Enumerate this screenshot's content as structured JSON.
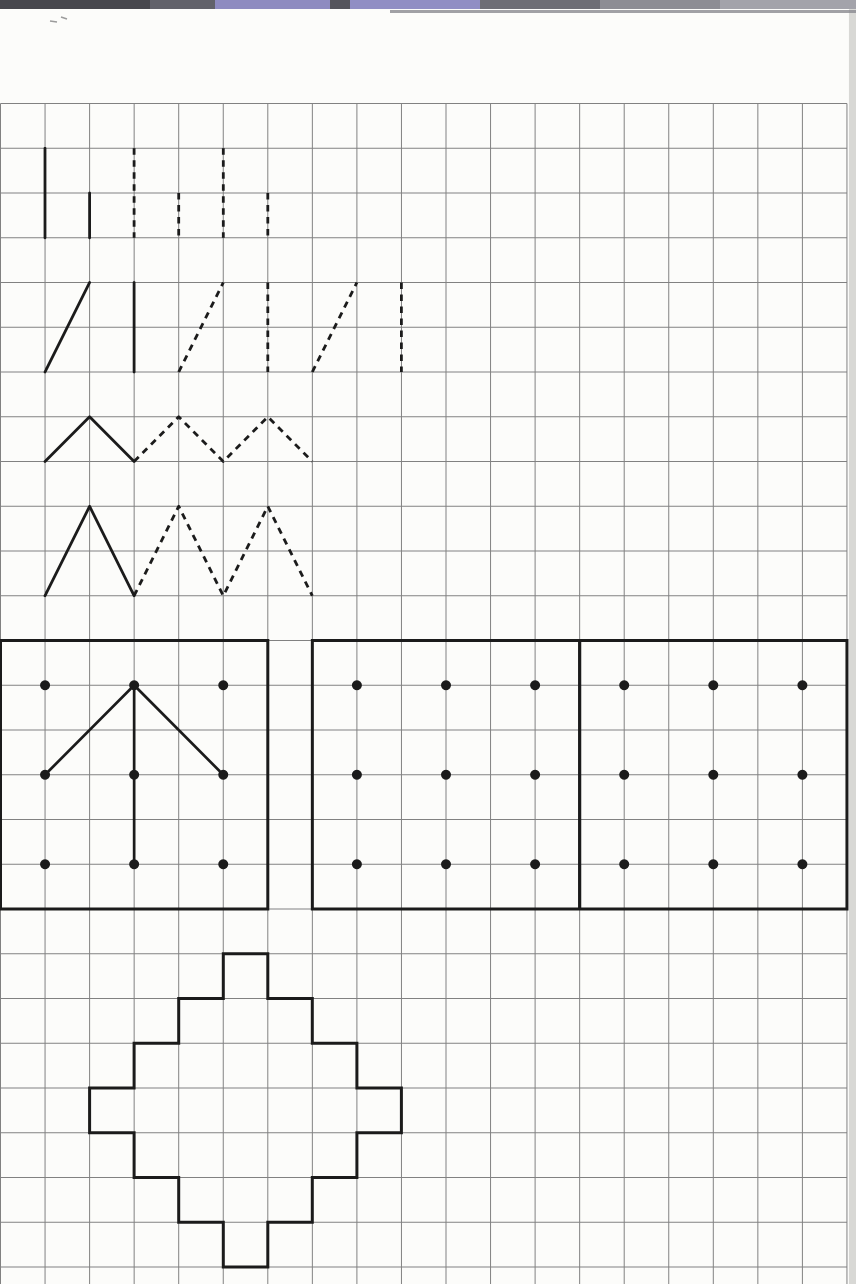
{
  "page": {
    "width": 856,
    "height": 1284,
    "background": "#fcfcfa",
    "ink_color": "#1b1b1b",
    "grid_color": "#818181",
    "paper_edge_color": "#d8d8d5",
    "pencil_color": "#9b9b9b",
    "grid": {
      "origin_x": 0.5,
      "origin_y": 103.5,
      "cell_w": 44.55,
      "cell_h": 44.75,
      "cols": 19,
      "rows": 26,
      "bottom": 1284
    },
    "scan_strip": {
      "height": 9,
      "segments": [
        {
          "x": 0,
          "w": 150,
          "color": "#47474d"
        },
        {
          "x": 150,
          "w": 65,
          "color": "#62626a"
        },
        {
          "x": 215,
          "w": 115,
          "color": "#8e8bc0"
        },
        {
          "x": 330,
          "w": 20,
          "color": "#55555c"
        },
        {
          "x": 350,
          "w": 130,
          "color": "#918ec4"
        },
        {
          "x": 480,
          "w": 120,
          "color": "#6e6e75"
        },
        {
          "x": 600,
          "w": 120,
          "color": "#8d8d94"
        },
        {
          "x": 720,
          "w": 136,
          "color": "#a3a3aa"
        }
      ],
      "underline": {
        "x": 390,
        "y": 10,
        "w": 466,
        "h": 3,
        "color": "#8a8a90"
      }
    },
    "pencil_marks": [
      {
        "x1": 50,
        "y1": 21,
        "x2": 57,
        "y2": 22
      },
      {
        "x1": 61,
        "y1": 17,
        "x2": 67,
        "y2": 19
      }
    ]
  },
  "practice_strokes": {
    "stroke_width": 2.8,
    "dash_pattern": "6.5 5.5",
    "rows": [
      {
        "name": "vertical-lines",
        "items": [
          {
            "style": "solid",
            "points": [
              [
                1,
                1
              ],
              [
                1,
                3
              ]
            ]
          },
          {
            "style": "solid",
            "points": [
              [
                2,
                2
              ],
              [
                2,
                3
              ]
            ]
          },
          {
            "style": "dashed",
            "points": [
              [
                3,
                1
              ],
              [
                3,
                3
              ]
            ]
          },
          {
            "style": "dashed",
            "points": [
              [
                4,
                2
              ],
              [
                4,
                3
              ]
            ]
          },
          {
            "style": "dashed",
            "points": [
              [
                5,
                1
              ],
              [
                5,
                3
              ]
            ]
          },
          {
            "style": "dashed",
            "points": [
              [
                6,
                2
              ],
              [
                6,
                3
              ]
            ]
          }
        ]
      },
      {
        "name": "slants-and-verticals",
        "items": [
          {
            "style": "solid",
            "points": [
              [
                1,
                6
              ],
              [
                2,
                4
              ]
            ]
          },
          {
            "style": "solid",
            "points": [
              [
                3,
                4
              ],
              [
                3,
                6
              ]
            ]
          },
          {
            "style": "dashed",
            "points": [
              [
                4,
                6
              ],
              [
                5,
                4
              ]
            ]
          },
          {
            "style": "dashed",
            "points": [
              [
                6,
                4
              ],
              [
                6,
                6
              ]
            ]
          },
          {
            "style": "dashed",
            "points": [
              [
                7,
                6
              ],
              [
                8,
                4
              ]
            ]
          },
          {
            "style": "dashed",
            "points": [
              [
                9,
                4
              ],
              [
                9,
                6
              ]
            ]
          }
        ]
      },
      {
        "name": "small-zigzag",
        "items": [
          {
            "style": "solid",
            "points": [
              [
                1,
                8
              ],
              [
                2,
                7
              ],
              [
                3,
                8
              ]
            ]
          },
          {
            "style": "dashed",
            "points": [
              [
                3,
                8
              ],
              [
                4,
                7
              ],
              [
                5,
                8
              ],
              [
                6,
                7
              ],
              [
                7,
                8
              ]
            ]
          }
        ]
      },
      {
        "name": "tall-zigzag",
        "items": [
          {
            "style": "solid",
            "points": [
              [
                1,
                11
              ],
              [
                2,
                9
              ],
              [
                3,
                11
              ]
            ]
          },
          {
            "style": "dashed",
            "points": [
              [
                3,
                11
              ],
              [
                4,
                9
              ],
              [
                5,
                11
              ],
              [
                6,
                9
              ],
              [
                7,
                11
              ]
            ]
          }
        ]
      }
    ]
  },
  "dot_boxes": {
    "border_width": 3,
    "dot_radius": 5,
    "dot_rows": [
      13,
      15,
      17
    ],
    "boxes": [
      {
        "x0": 0,
        "y0": 12,
        "x1": 6,
        "y1": 18,
        "dot_cols": [
          1,
          3,
          5
        ],
        "figure": [
          [
            [
              1,
              15
            ],
            [
              3,
              13
            ]
          ],
          [
            [
              3,
              13
            ],
            [
              5,
              15
            ]
          ],
          [
            [
              3,
              13
            ],
            [
              3,
              17
            ]
          ]
        ]
      },
      {
        "x0": 7,
        "y0": 12,
        "x1": 13,
        "y1": 18,
        "dot_cols": [
          8,
          10,
          12
        ],
        "figure": []
      },
      {
        "x0": 13,
        "y0": 12,
        "x1": 19,
        "y1": 18,
        "dot_cols": [
          14,
          16,
          18
        ],
        "figure": []
      }
    ]
  },
  "stepped_diamond": {
    "stroke_width": 3,
    "vertices": [
      [
        5,
        19
      ],
      [
        6,
        19
      ],
      [
        6,
        20
      ],
      [
        7,
        20
      ],
      [
        7,
        21
      ],
      [
        8,
        21
      ],
      [
        8,
        22
      ],
      [
        9,
        22
      ],
      [
        9,
        23
      ],
      [
        8,
        23
      ],
      [
        8,
        24
      ],
      [
        7,
        24
      ],
      [
        7,
        25
      ],
      [
        6,
        25
      ],
      [
        6,
        26
      ],
      [
        5,
        26
      ],
      [
        5,
        25
      ],
      [
        4,
        25
      ],
      [
        4,
        24
      ],
      [
        3,
        24
      ],
      [
        3,
        23
      ],
      [
        2,
        23
      ],
      [
        2,
        22
      ],
      [
        3,
        22
      ],
      [
        3,
        21
      ],
      [
        4,
        21
      ],
      [
        4,
        20
      ],
      [
        5,
        20
      ]
    ]
  }
}
